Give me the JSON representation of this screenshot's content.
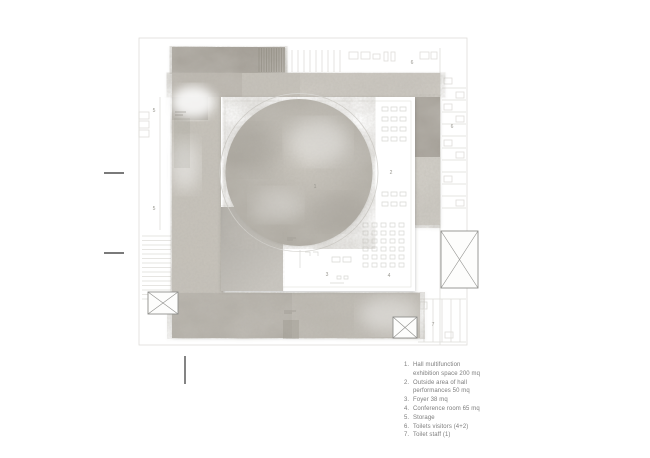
{
  "plan": {
    "room_labels": [
      {
        "space": "hall-multifunction-exhibition",
        "number": "1"
      },
      {
        "space": "outside-performance-area",
        "number": "2"
      },
      {
        "space": "foyer",
        "number": "3"
      },
      {
        "space": "conference-room",
        "number": "4"
      },
      {
        "space": "storage-upper",
        "number": "5"
      },
      {
        "space": "storage-lower",
        "number": "5"
      },
      {
        "space": "toilets-visitors-top",
        "number": "6"
      },
      {
        "space": "toilets-visitors-right",
        "number": "6"
      },
      {
        "space": "toilet-staff",
        "number": "7"
      }
    ],
    "colors": {
      "background": "#ffffff",
      "concrete_dark": "#a5a098",
      "concrete_mid": "#c6c2ba",
      "concrete_light": "#d1cec7",
      "concrete_bottom": "#bcb8b0",
      "circle_base": "#b6b2aa",
      "faint_line": "#dcdbd7",
      "label_text": "#98968f",
      "marker": "#4f4f4f",
      "legend_text": "#7d7d7d"
    }
  },
  "legend": {
    "items": [
      {
        "number": "1.",
        "text": "Hall multifunction\nexhibition space 200 mq"
      },
      {
        "number": "2.",
        "text": "Outside area of hall\nperformances 50 mq"
      },
      {
        "number": "3.",
        "text": "Foyer 38 mq"
      },
      {
        "number": "4.",
        "text": "Conference room 65 mq"
      },
      {
        "number": "5.",
        "text": "Storage"
      },
      {
        "number": "6.",
        "text": "Toilets visitors (4+2)"
      },
      {
        "number": "7.",
        "text": "Toilet staff (1)"
      }
    ]
  }
}
